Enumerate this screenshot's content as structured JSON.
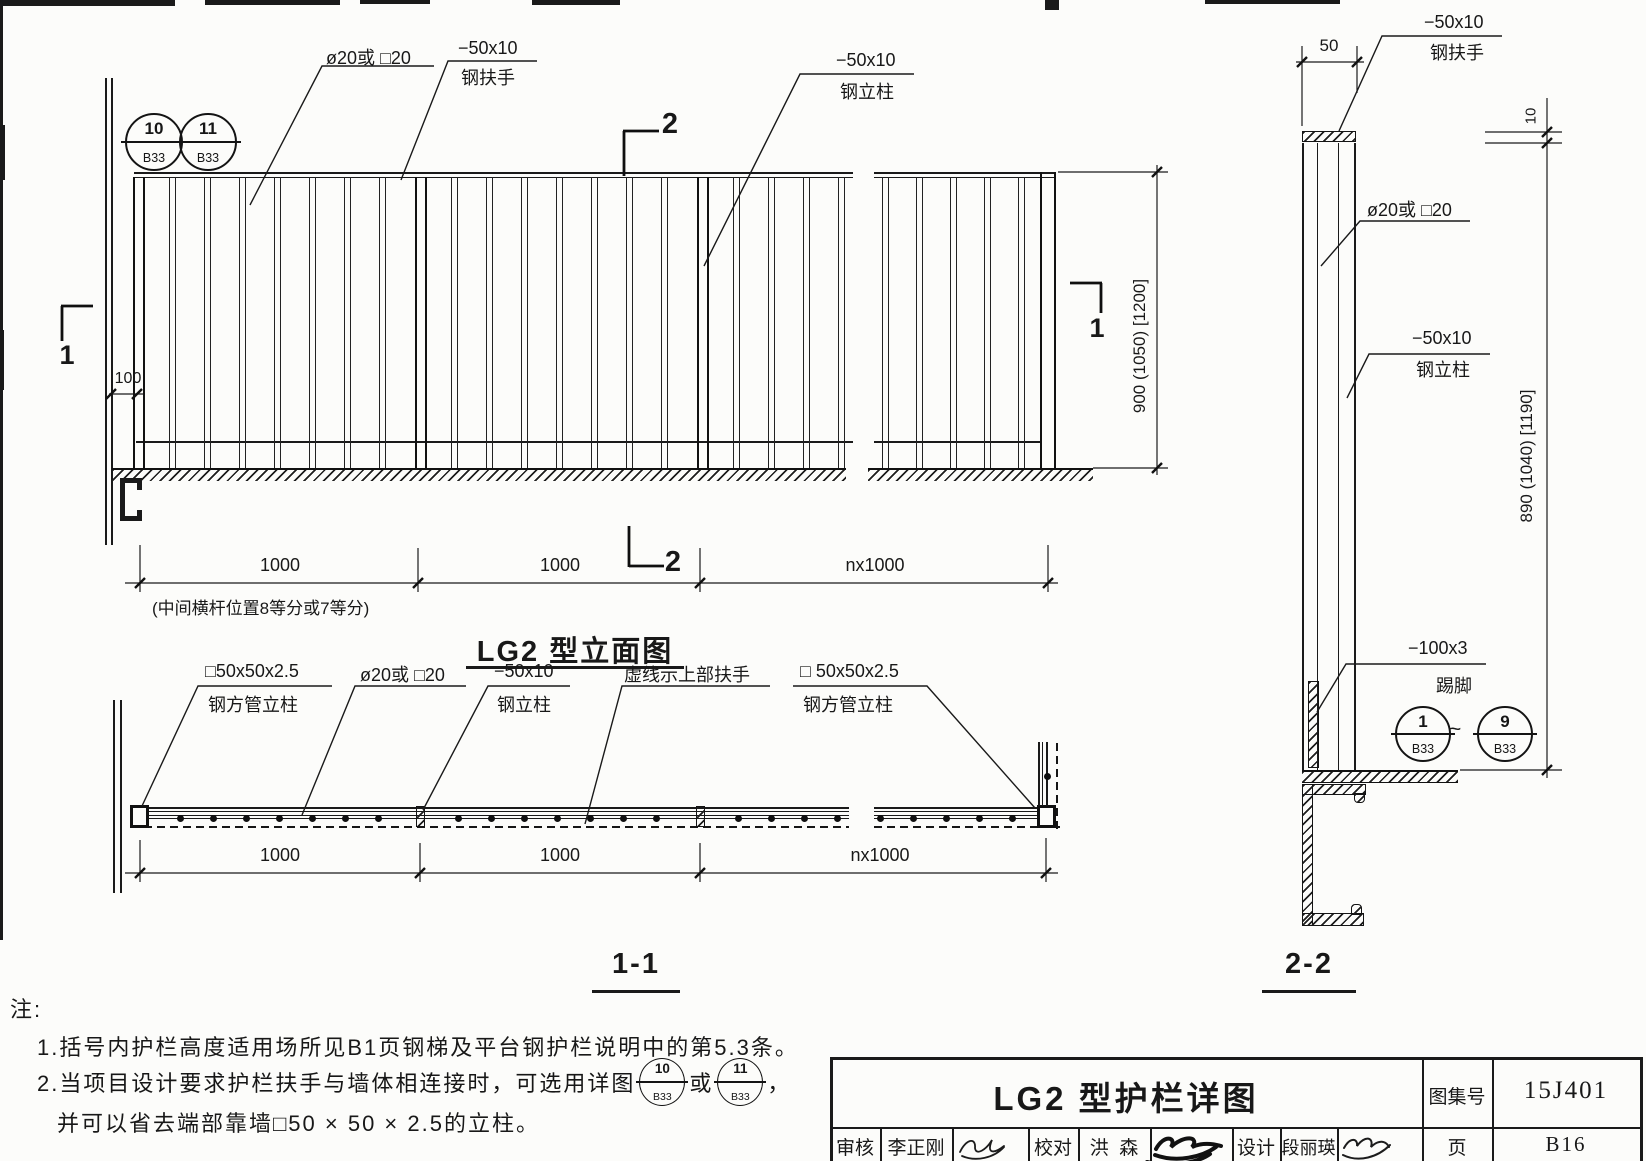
{
  "elevation": {
    "title": "LG2 型立面图",
    "ref_left": {
      "num": "10",
      "page": "B33"
    },
    "ref_right": {
      "num": "11",
      "page": "B33"
    },
    "label_baluster": "ø20或 □20",
    "label_handrail_spec": "−50x10",
    "label_handrail": "钢扶手",
    "label_post_spec": "−50x10",
    "label_post": "钢立柱",
    "dim_offset": "100",
    "dim_1": "1000",
    "dim_2": "1000",
    "dim_3": "nx1000",
    "dim_note": "(中间横杆位置8等分或7等分)",
    "dim_height": "900 (1050) [1200]",
    "mark_1": "1",
    "mark_2": "2"
  },
  "plan": {
    "title": "1-1",
    "label_sqpost_spec": "□50x50x2.5",
    "label_sqpost": "钢方管立柱",
    "label_baluster": "ø20或 □20",
    "label_post_spec": "−50x10",
    "label_post": "钢立柱",
    "label_dashed": "虚线示上部扶手",
    "label_sqpost2_spec": "□ 50x50x2.5",
    "label_sqpost2": "钢方管立柱",
    "dim_1": "1000",
    "dim_2": "1000",
    "dim_3": "nx1000"
  },
  "section": {
    "title": "2-2",
    "dim_top": "50",
    "dim_thickness": "10",
    "dim_height": "890 (1040) [1190]",
    "label_handrail_spec": "−50x10",
    "label_handrail": "钢扶手",
    "label_baluster": "ø20或 □20",
    "label_post_spec": "−50x10",
    "label_post": "钢立柱",
    "label_kick_spec": "−100x3",
    "label_kick": "踢脚",
    "ref_from": {
      "num": "1",
      "page": "B33"
    },
    "tilde": "~",
    "ref_to": {
      "num": "9",
      "page": "B33"
    }
  },
  "notes": {
    "heading": "注:",
    "note1": "1.括号内护栏高度适用场所见B1页钢梯及平台钢护栏说明中的第5.3条。",
    "note2_pre": "2.当项目设计要求护栏扶手与墙体相连接时，可选用详图",
    "note2_ref1": {
      "num": "10",
      "page": "B33"
    },
    "note2_or": "或",
    "note2_ref2": {
      "num": "11",
      "page": "B33"
    },
    "note2_comma": "，",
    "note2_line2": "并可以省去端部靠墙□50 × 50 × 2.5的立柱。"
  },
  "titleblock": {
    "title": "LG2 型护栏详图",
    "atlas_label": "图集号",
    "atlas_value": "15J401",
    "page_label": "页",
    "page_value": "B16",
    "reviewer_label": "审核",
    "reviewer": "李正刚",
    "checker_label": "校对",
    "checker": "洪  森",
    "designer_label": "设计",
    "designer": "段丽瑛"
  }
}
